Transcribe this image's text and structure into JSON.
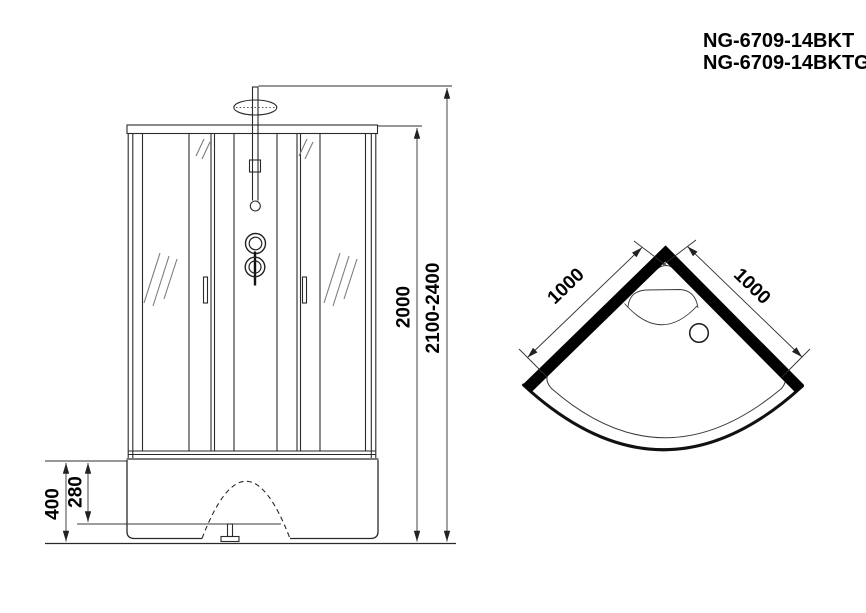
{
  "title": {
    "line1": "NG-6709-14BKT",
    "line2": "NG-6709-14BKTG"
  },
  "front_view": {
    "height_glass_mm": "2000",
    "height_total_mm": "2100-2400",
    "base_height_mm": "400",
    "base_inner_height_mm": "280"
  },
  "top_view": {
    "side_left_mm": "1000",
    "side_right_mm": "1000"
  },
  "colors": {
    "line": "#2a2a2a",
    "wall": "#000000",
    "background": "#ffffff"
  }
}
